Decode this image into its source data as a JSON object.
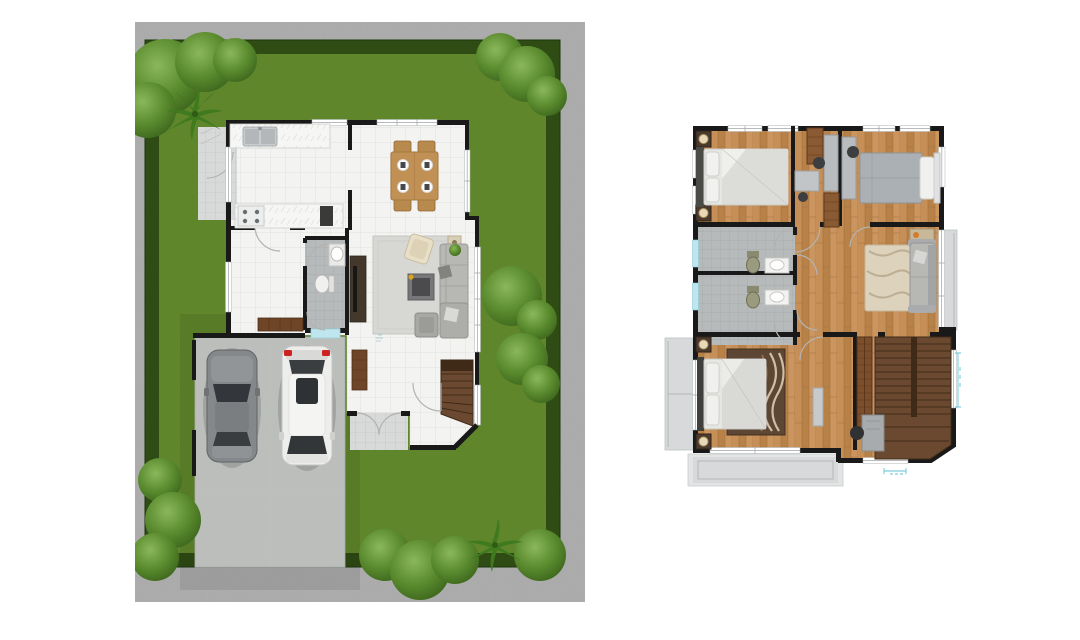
{
  "page": {
    "description": "two rendered floor plans on white background",
    "left_plan": {
      "name": "first-floor-with-garden",
      "features": [
        "hedge-border",
        "lawn",
        "corner-trees",
        "side-patio",
        "kitchen",
        "dining-area",
        "living-area",
        "bathroom",
        "hallway",
        "staircase",
        "entry-porch",
        "driveway"
      ],
      "cars": [
        {
          "type": "sedan",
          "color": "gray"
        },
        {
          "type": "suv",
          "color": "white"
        }
      ],
      "dining_seats": 4
    },
    "right_plan": {
      "name": "second-floor",
      "features": [
        "bedroom-left",
        "bedroom-right",
        "study-nook",
        "bathroom-1",
        "bathroom-2",
        "family-area",
        "master-bedroom",
        "wardrobe",
        "staircase",
        "desk",
        "balcony-left",
        "balcony-bottom",
        "balcony-right"
      ],
      "bedrooms": 3,
      "bathrooms": 2
    }
  },
  "palette": {
    "lawn": "#6f9b33",
    "hedge": "#47721f",
    "hedge_edge": "#2e5214",
    "foliage": "#5a8a2e",
    "concrete": "#ccd0cc",
    "wall": "#191919",
    "tile": "#f3f3f1",
    "tile_line": "#e2e2e0",
    "porch": "#d8dad9",
    "bath_tile": "#b7babb",
    "wood": "#c08a52",
    "wood_dark": "#a87840",
    "stair": "#6b4930",
    "stair_dark": "#3f2a18",
    "dark_wood": "#6e4526",
    "table_wood": "#c09055",
    "balcony": "#d7d9da",
    "sofa": "#b7b7b4",
    "rug_gray": "#d7d7d4",
    "rug_beige": "#ddd2bc",
    "rug_brown": "#5d4633",
    "bed_white": "#e6e6e3",
    "bed_gray": "#aab0b4",
    "lamp_cream": "#ead9b8",
    "cyan": "#bfe6ee",
    "dim": "#66c2d6",
    "red": "#cc2222",
    "orange": "#d27c2c",
    "car_gray": "#85888a",
    "car_white": "#ededeb",
    "glass": "#33363a",
    "marble": "#f6f6f4"
  }
}
